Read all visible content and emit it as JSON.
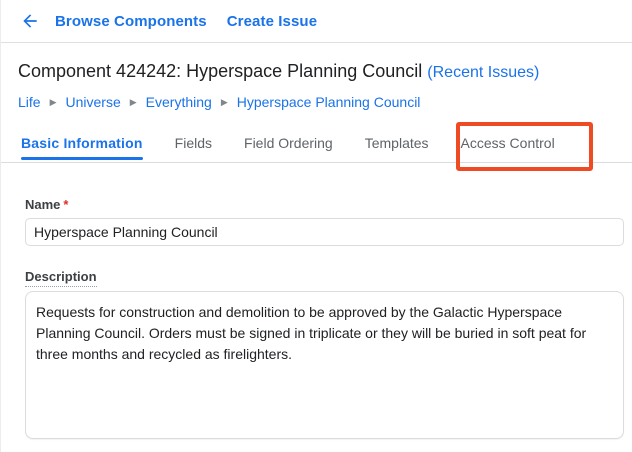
{
  "topbar": {
    "links": {
      "browse_components": "Browse Components",
      "create_issue": "Create Issue"
    }
  },
  "header": {
    "title": "Component 424242: Hyperspace Planning Council",
    "recent_issues": "(Recent Issues)"
  },
  "breadcrumb": {
    "separator": "▶",
    "items": [
      "Life",
      "Universe",
      "Everything",
      "Hyperspace Planning Council"
    ]
  },
  "tabs": {
    "items": [
      {
        "label": "Basic Information",
        "active": true
      },
      {
        "label": "Fields",
        "active": false
      },
      {
        "label": "Field Ordering",
        "active": false
      },
      {
        "label": "Templates",
        "active": false
      },
      {
        "label": "Access Control",
        "active": false,
        "highlighted": true
      }
    ]
  },
  "form": {
    "name": {
      "label": "Name",
      "required_marker": "*",
      "value": "Hyperspace Planning Council"
    },
    "description": {
      "label": "Description",
      "value": "Requests for construction and demolition to be approved by the Galactic Hyperspace Planning Council. Orders must be signed in triplicate or they will be buried in soft peat for three months and recycled as firelighters."
    }
  },
  "colors": {
    "link_blue": "#1a73e8",
    "tab_inactive": "#5f6368",
    "highlight_box": "#ee4a23",
    "required_asterisk": "#d93025",
    "border": "#dadce0"
  }
}
